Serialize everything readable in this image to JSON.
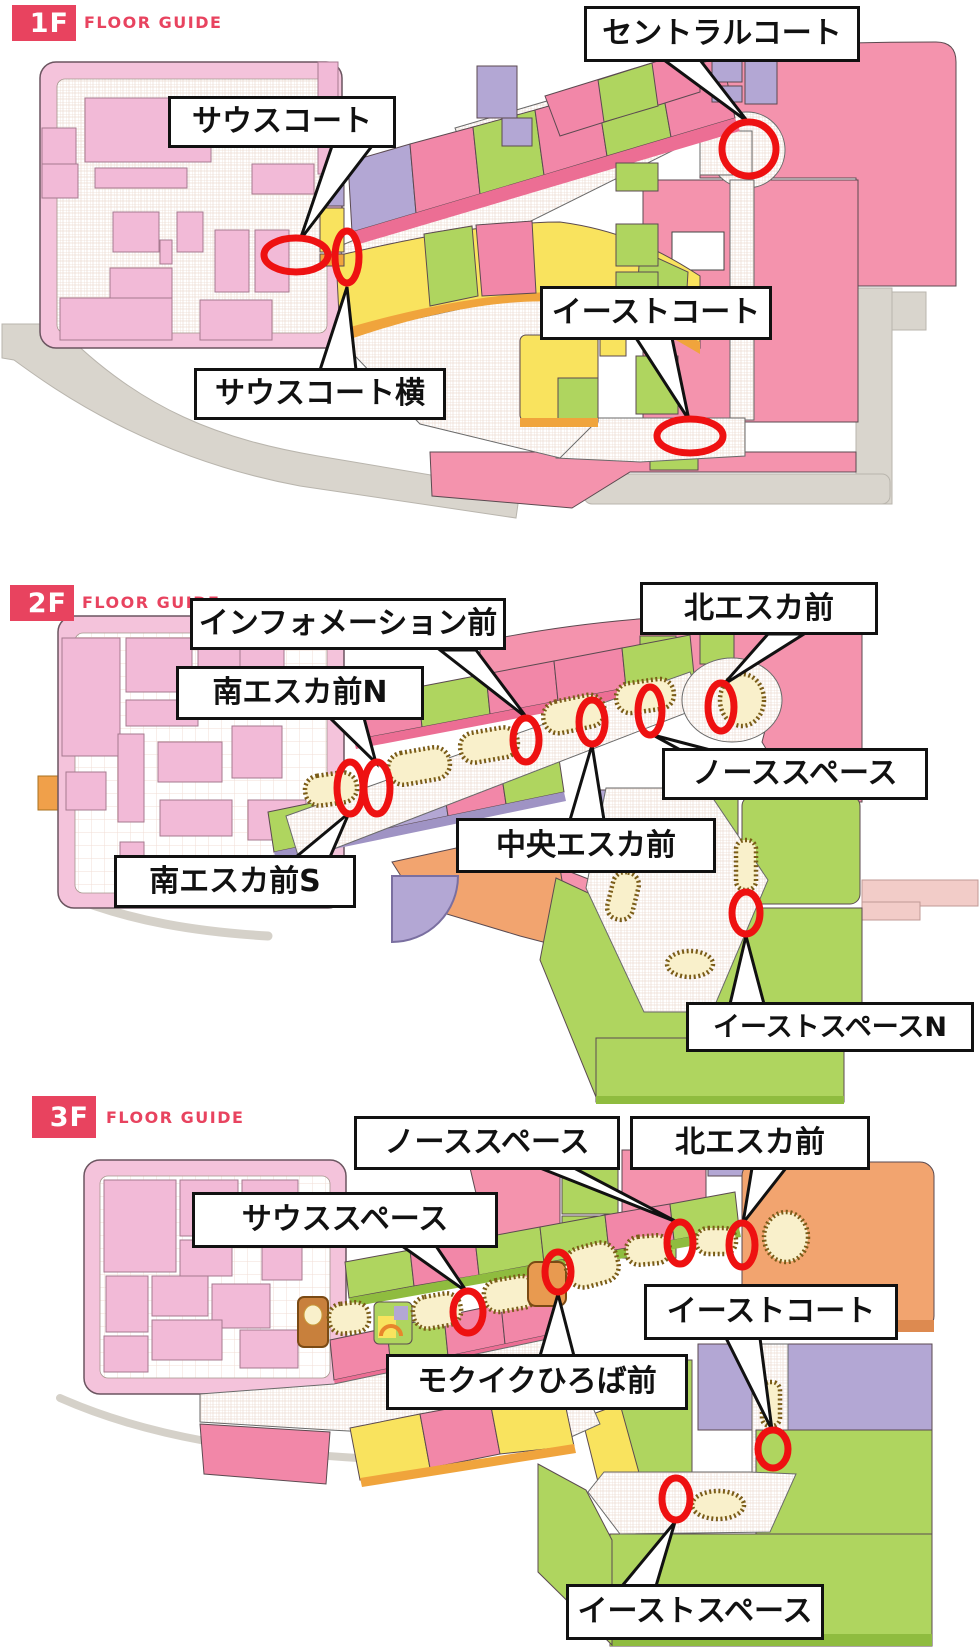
{
  "page": {
    "background": "#ffffff"
  },
  "theme": {
    "accent_red": "#e8435f",
    "marker_red": "#ee1111",
    "label_border": "#111111",
    "label_bg": "#ffffff",
    "map_pink": "#f493ad",
    "map_pink_light": "#f2bad7",
    "map_pink_front": "#ec6e94",
    "map_green": "#afd55f",
    "map_yellow": "#f9e35e",
    "map_purple": "#b3a7d4",
    "map_orange": "#f0a43c",
    "map_salmon": "#f2a46f",
    "kiosk_beige": "#f9f0cb",
    "road_gray": "#d9d5cd",
    "bridge_pink": "#f2ccc8"
  },
  "floors": [
    {
      "badge": "1F",
      "subtitle": "FLOOR GUIDE",
      "labels": {
        "south_court": "サウスコート",
        "central_court": "セントラルコート",
        "south_court_side": "サウスコート横",
        "east_court": "イーストコート"
      }
    },
    {
      "badge": "2F",
      "subtitle": "FLOOR GUIDE",
      "labels": {
        "information_front": "インフォメーション前",
        "north_esca_front": "北エスカ前",
        "south_esca_front_n": "南エスカ前N",
        "north_space": "ノーススペース",
        "central_esca_front": "中央エスカ前",
        "south_esca_front_s": "南エスカ前S",
        "east_space_n": "イーストスペースN"
      }
    },
    {
      "badge": "3F",
      "subtitle": "FLOOR GUIDE",
      "labels": {
        "north_space": "ノーススペース",
        "north_esca_front": "北エスカ前",
        "south_space": "サウススペース",
        "east_court": "イーストコート",
        "mokuiku_hiroba_front": "モクイクひろば前",
        "east_space": "イーストスペース"
      }
    }
  ]
}
